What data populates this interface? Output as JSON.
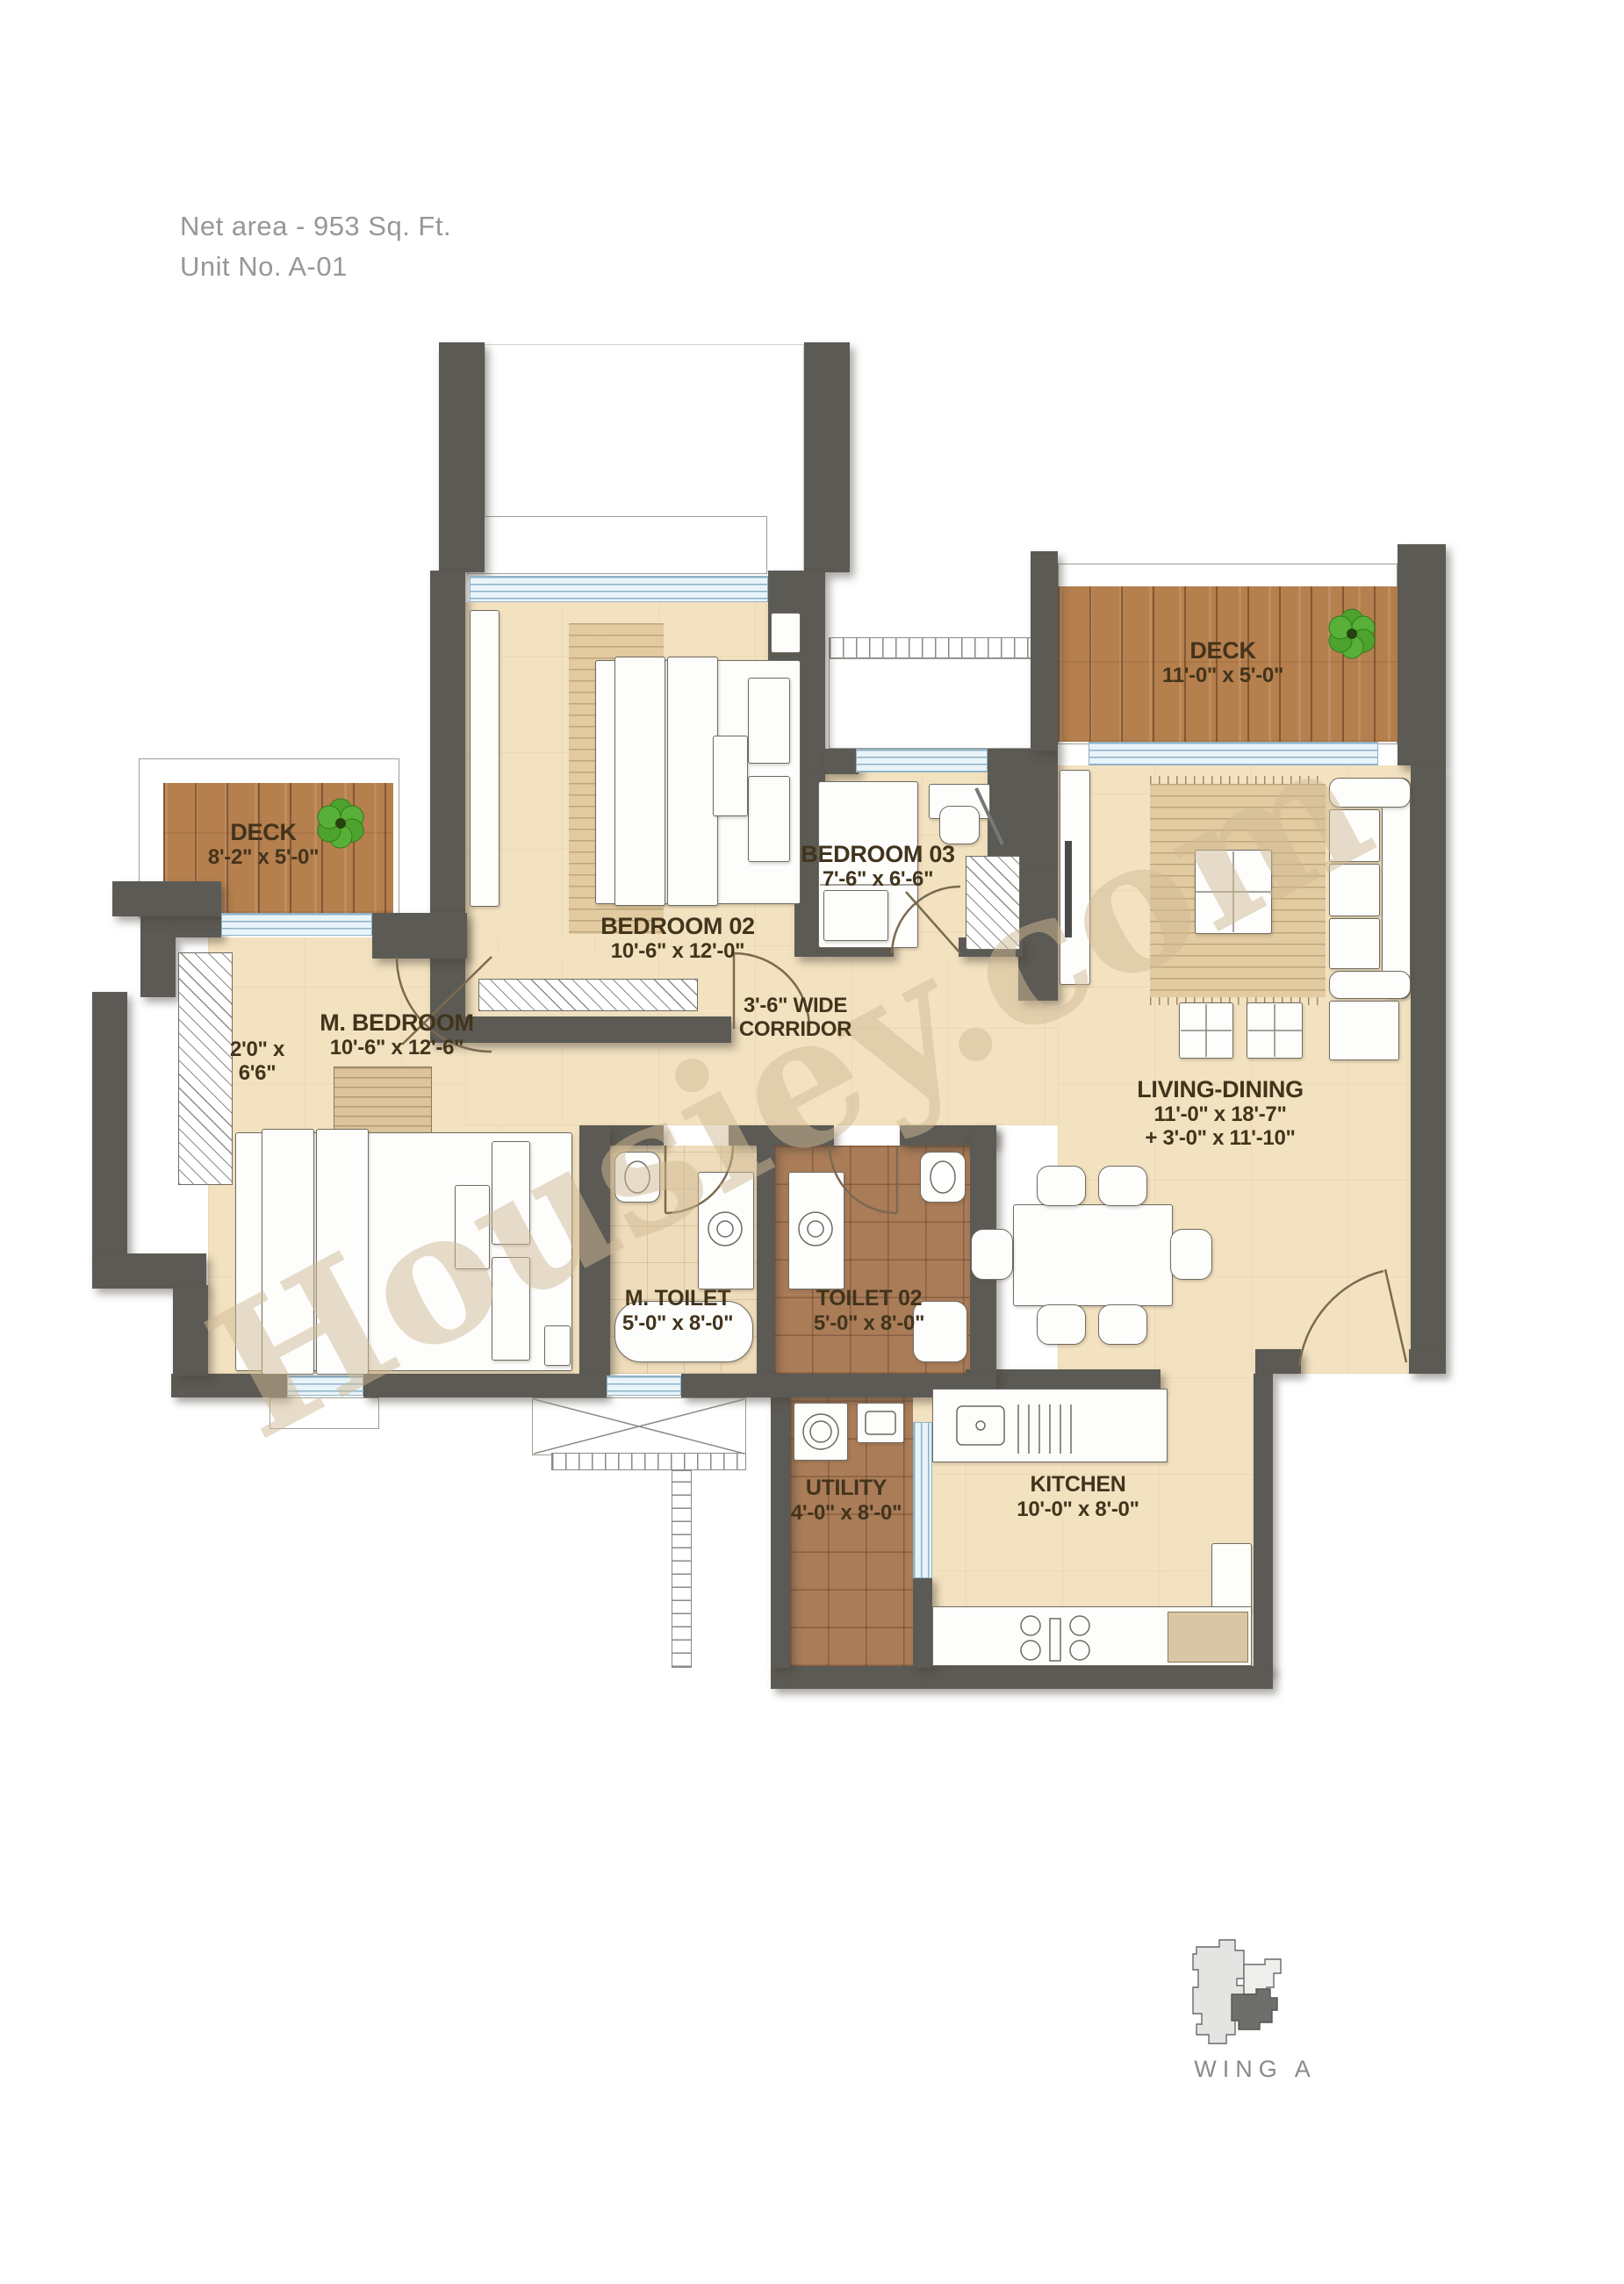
{
  "header": {
    "net_area": "Net area - 953 Sq. Ft.",
    "unit_no": "Unit No. A-01"
  },
  "watermark": "Housiey.com",
  "rooms": {
    "deck_right": {
      "name": "DECK",
      "dims": "11'-0\" x 5'-0\""
    },
    "deck_left": {
      "name": "DECK",
      "dims": "8'-2\" x 5'-0\""
    },
    "bedroom_02": {
      "name": "BEDROOM 02",
      "dims": "10'-6\" x 12'-0\""
    },
    "bedroom_03": {
      "name": "BEDROOM 03",
      "dims": "7'-6\" x 6'-6\""
    },
    "master_bedroom": {
      "name": "M. BEDROOM",
      "dims": "10'-6\" x 12'-6\""
    },
    "niche": {
      "line1": "2'0\" x",
      "line2": "6'6\""
    },
    "corridor": {
      "line1": "3'-6\" WIDE",
      "line2": "CORRIDOR"
    },
    "living_dining": {
      "name": "LIVING-DINING",
      "dims1": "11'-0\"  x 18'-7\"",
      "dims2": "+ 3'-0\" x 11'-10\""
    },
    "master_toilet": {
      "name": "M. TOILET",
      "dims": "5'-0\" x 8'-0\""
    },
    "toilet_02": {
      "name": "TOILET 02",
      "dims": "5'-0\" x 8'-0\""
    },
    "utility": {
      "name": "UTILITY",
      "dims": "4'-0\" x 8'-0\""
    },
    "kitchen": {
      "name": "KITCHEN",
      "dims": "10'-0\" x 8'-0\""
    }
  },
  "keyplan": {
    "label": "WING A"
  },
  "palette": {
    "wall": "#5c5a54",
    "floor": "#f3e2c0",
    "deck_wood": "#b57f4e",
    "toilet_tile": "#aa7c58",
    "window_glass": "#e9f4fa",
    "label_text": "#42341c",
    "header_text": "#979797",
    "watermark_color": "#d0ba94"
  }
}
